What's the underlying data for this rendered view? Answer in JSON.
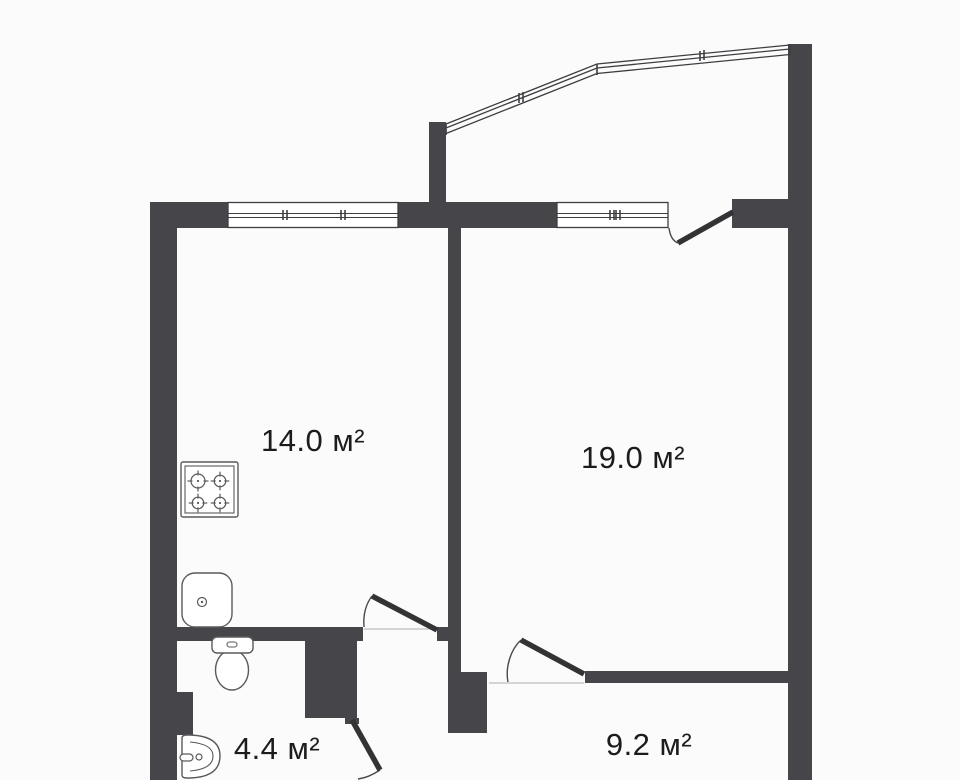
{
  "type": "floor-plan",
  "units": "м²",
  "rooms": [
    {
      "id": "kitchen",
      "area": "14.0 м²",
      "label_x": 313,
      "label_y": 441
    },
    {
      "id": "living-room",
      "area": "19.0 м²",
      "label_x": 633,
      "label_y": 458
    },
    {
      "id": "bathroom",
      "area": "4.4 м²",
      "label_x": 277,
      "label_y": 749
    },
    {
      "id": "bedroom",
      "area": "9.2 м²",
      "label_x": 649,
      "label_y": 745
    }
  ],
  "colors": {
    "background": "#fbfbfb",
    "wall": "#46464a",
    "outline": "#3e3e42",
    "door_leaf": "#333336",
    "arc": "#4a4a4e",
    "threshold": "#c8c8c8",
    "fixture": "#5a5a5e",
    "label_text": "#1c1c1c"
  },
  "walls": [
    {
      "name": "outer-left",
      "x": 150,
      "y": 202,
      "w": 27,
      "h": 578
    },
    {
      "name": "top-kitchen-left",
      "x": 150,
      "y": 202,
      "w": 78,
      "h": 26
    },
    {
      "name": "top-middle",
      "x": 398,
      "y": 202,
      "w": 159,
      "h": 26
    },
    {
      "name": "top-right",
      "x": 732,
      "y": 199,
      "w": 80,
      "h": 29
    },
    {
      "name": "outer-right",
      "x": 788,
      "y": 44,
      "w": 24,
      "h": 736
    },
    {
      "name": "balcony-left",
      "x": 429,
      "y": 122,
      "w": 17,
      "h": 82
    },
    {
      "name": "kitchen-living",
      "x": 448,
      "y": 228,
      "w": 13,
      "h": 444
    },
    {
      "name": "hall-corner",
      "x": 448,
      "y": 672,
      "w": 39,
      "h": 61
    },
    {
      "name": "kitchen-bottom",
      "x": 177,
      "y": 627,
      "w": 186,
      "h": 14
    },
    {
      "name": "kitchen-door-jamb",
      "x": 437,
      "y": 627,
      "w": 11,
      "h": 14
    },
    {
      "name": "bathroom-right",
      "x": 305,
      "y": 641,
      "w": 52,
      "h": 77
    },
    {
      "name": "bathroom-door-jamb",
      "x": 345,
      "y": 718,
      "w": 14,
      "h": 6
    },
    {
      "name": "bathroom-left-step",
      "x": 177,
      "y": 692,
      "w": 16,
      "h": 43
    },
    {
      "name": "living-bedroom",
      "x": 585,
      "y": 671,
      "w": 227,
      "h": 12
    }
  ],
  "windows": [
    {
      "name": "kitchen-window",
      "x": 228,
      "y": 202,
      "w": 170,
      "h": 26,
      "ticks": [
        283,
        341
      ]
    },
    {
      "name": "living-window",
      "x": 557,
      "y": 202,
      "w": 111,
      "h": 26,
      "ticks": [
        610,
        616
      ]
    }
  ],
  "balcony": {
    "name": "balcony-glazing",
    "points": [
      [
        446,
        124
      ],
      [
        597,
        64
      ],
      [
        790,
        45
      ]
    ],
    "offsets": [
      0,
      4,
      9.5
    ],
    "cap_height": 11,
    "joint": [
      597,
      64,
      597,
      75
    ],
    "ticks": [
      [
        519,
        93
      ],
      [
        700,
        51
      ]
    ]
  },
  "doors": [
    {
      "name": "balcony-door",
      "leaf": [
        733,
        212,
        678,
        243
      ],
      "arc": "M 669 228 C 670 236 673 241 678 243"
    },
    {
      "name": "kitchen-door",
      "leaf": [
        437,
        630,
        372,
        596
      ],
      "arc": "M 364 627 C 363 615 366 604 372 596",
      "threshold": [
        364,
        629,
        437,
        629
      ]
    },
    {
      "name": "living-room-door",
      "leaf": [
        584,
        674,
        521,
        640
      ],
      "arc": "M 508 682 C 505 667 511 649 521 640",
      "threshold": [
        489,
        683,
        584,
        683
      ]
    },
    {
      "name": "bathroom-door",
      "leaf": [
        352,
        720,
        380,
        770
      ],
      "arc": "M 358 779 C 366 778 374 774 380 770"
    }
  ],
  "fixtures": [
    {
      "name": "stove-icon",
      "type": "stove",
      "x": 181,
      "y": 462,
      "w": 57,
      "h": 55
    },
    {
      "name": "kitchen-sink-icon",
      "type": "sink",
      "x": 181,
      "y": 572,
      "w": 52,
      "h": 56
    },
    {
      "name": "toilet-icon",
      "type": "toilet",
      "x": 212,
      "y": 637,
      "w": 41,
      "h": 54
    },
    {
      "name": "washbasin-icon",
      "type": "washbasin",
      "x": 182,
      "y": 735,
      "w": 38,
      "h": 43
    }
  ]
}
